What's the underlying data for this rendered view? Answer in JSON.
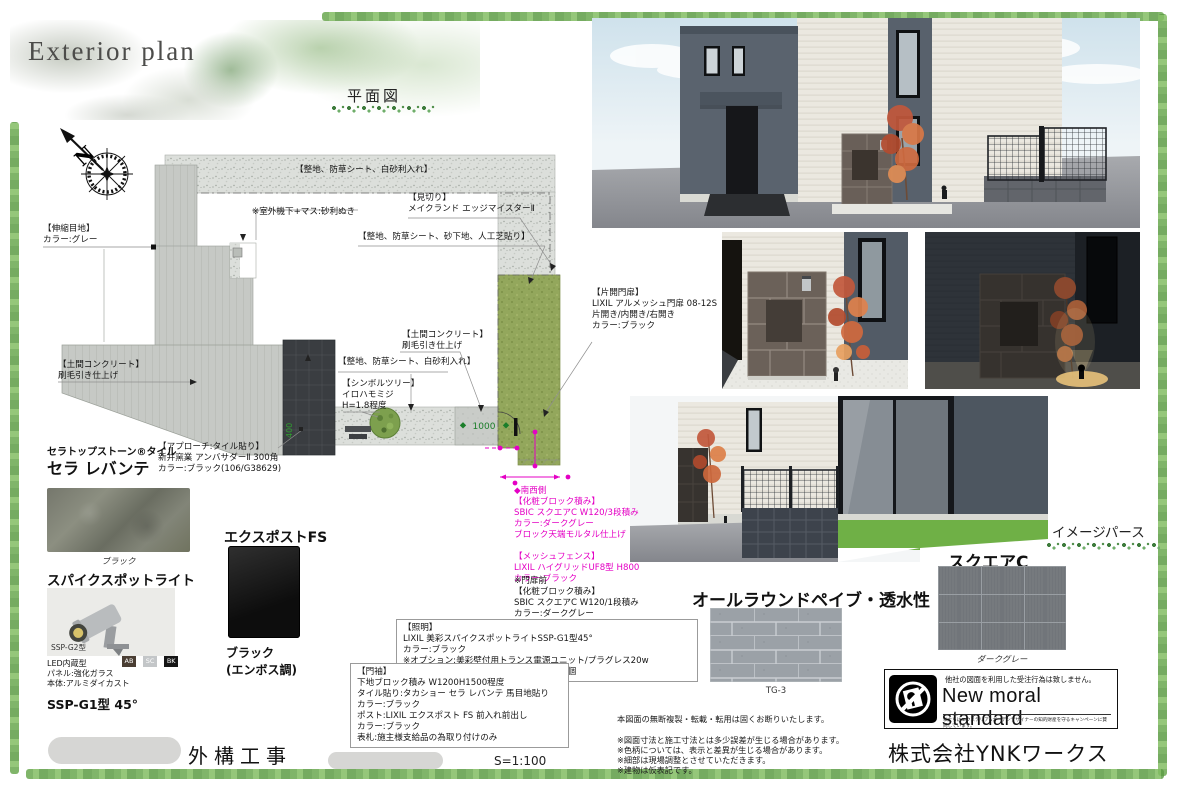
{
  "header": {
    "title": "Exterior plan",
    "plan_view_label": "平面図",
    "perspective_label": "イメージパース"
  },
  "plan": {
    "annotations": {
      "gravel_top": "【整地、防草シート、白砂利入れ】",
      "ac_unit": "※室外機下+マス:砂利ぬき",
      "edging": "【見切り】\nメイクランド エッジマイスターⅡ",
      "turf": "【整地、防草シート、砂下地、人工芝貼り】",
      "expansion_joint": "【伸縮目地】\nカラー:グレー",
      "concrete_left": "【土間コンクリート】\n刷毛引き仕上げ",
      "concrete_center": "【土間コンクリート】\n刷毛引き仕上げ",
      "gravel_center": "【整地、防草シート、白砂利入れ】",
      "symbol_tree": "【シンボルツリー】\nイロハモミジ\nH=1.8程度",
      "approach": "【アプローチ:タイル貼り】\n新井窯業 アンバサダーⅡ 300角\nカラー:ブラック(106/G38629)",
      "gate": "【片開門扉】\nLIXIL アルメッシュ門扉 08-12S\n片開き/内開き/右開き\nカラー:ブラック",
      "southwest": "◆南西側\n【化粧ブロック積み】\nSBIC スクエアC W120/3段積み\nカラー:ダークグレー\nブロック天端モルタル仕上げ\n\n【メッシュフェンス】\nLIXIL ハイグリッドUF8型 H800\nカラー:ブラック",
      "gate_front": "※門扉前\n【化粧ブロック積み】\nSBIC スクエアC W120/1段積み\nカラー:ダークグレー\nブロック天端モルタル仕上げ",
      "lighting": "【照明】\nLIXIL 美彩スパイクスポットライトSSP-G1型45°\nカラー:ブラック\n※オプション:美彩壁付用トランス電源ユニット/プラグレス20w\n　　　　　　8VLR31BK/防水ジョイント1個",
      "gate_wall": "【門袖】\n下地ブロック積み W1200H1500程度\nタイル貼り:タカショー セラ レバンテ 馬目地貼り\nカラー:ブラック\nポスト:LIXIL エクスポスト FS 前入れ前出し\nカラー:ブラック\n表札:施主様支給品の為取り付けのみ"
    },
    "dimensions": {
      "pad_width": "1000",
      "approach_width": "400"
    },
    "compass_label": "N"
  },
  "products": {
    "tile": {
      "series": "セラトップストーン®タイル",
      "name": "セラ レバンテ",
      "color": "ブラック"
    },
    "postbox": {
      "name": "エクスポストFS",
      "color": "ブラック\n(エンボス調)"
    },
    "spotlight": {
      "name": "スパイクスポットライト",
      "photo_model": "SSP-G2型",
      "specs": "LED内蔵型\nパネル:強化ガラス\n本体:アルミダイカスト",
      "finish_chips": [
        "AB",
        "SC",
        "BK"
      ],
      "model": "SSP-G1型 45°"
    },
    "paver": {
      "name": "オールラウンドペイブ・透水性",
      "color": "TG-3"
    },
    "block": {
      "name": "スクエアC",
      "color": "ダークグレー"
    }
  },
  "footer": {
    "project": "外構工事",
    "scale": "S=1:100",
    "company": "株式会社YNKワークス",
    "notes": "本図面の無断複製・転載・転用は固くお断りいたします。\n\n※図面寸法と施工寸法とは多少誤差が生じる場合があります。\n※色柄については、表示と差異が生じる場合があります。\n※細部は現場調整とさせていただきます。\n※建物は仮表記です。",
    "moral": {
      "caption": "他社の図面を利用した受注行為は致しません。",
      "title": "New moral standard",
      "subtitle": "私たちはエクステリア&ガーデンデザイナーの知的財産を守るキャンペーンに賛同しています。"
    }
  },
  "colors": {
    "accent_magenta": "#e400c4",
    "dimension_green": "#1b7e2a",
    "frame_green": "#6aa84f",
    "lawn_green": "#93a75c"
  }
}
